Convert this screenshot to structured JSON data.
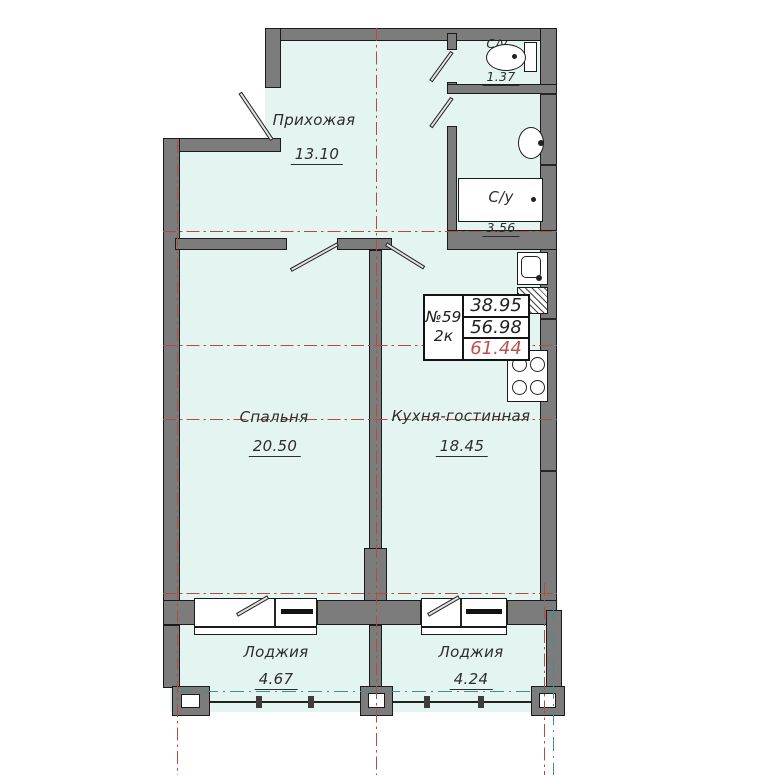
{
  "plan": {
    "rooms": [
      {
        "id": "hallway",
        "name": "Прихожая",
        "area": "13.10"
      },
      {
        "id": "wc",
        "name": "С/у",
        "area": "1.37"
      },
      {
        "id": "bathroom",
        "name": "С/у",
        "area": "3.56"
      },
      {
        "id": "bedroom",
        "name": "Спальня",
        "area": "20.50"
      },
      {
        "id": "kitchen",
        "name": "Кухня-гостинная",
        "area": "18.45"
      },
      {
        "id": "loggia-left",
        "name": "Лоджия",
        "area": "4.67"
      },
      {
        "id": "loggia-right",
        "name": "Лоджия",
        "area": "4.24"
      }
    ],
    "info_box": {
      "flat_number": "№59",
      "flat_type": "2к",
      "areas": [
        "38.95",
        "56.98",
        "61.44"
      ],
      "highlighted_value": "61.44"
    },
    "fixtures": [
      "toilet",
      "washbasin",
      "bathtub",
      "kitchen-sink",
      "vent-shaft",
      "stove"
    ],
    "colors": {
      "floor": "#e4f4f1",
      "wall": "#7c7c7c",
      "axis_red": "#b24b40",
      "axis_teal": "#3f8f8c",
      "highlight_red": "#c0504d"
    }
  }
}
